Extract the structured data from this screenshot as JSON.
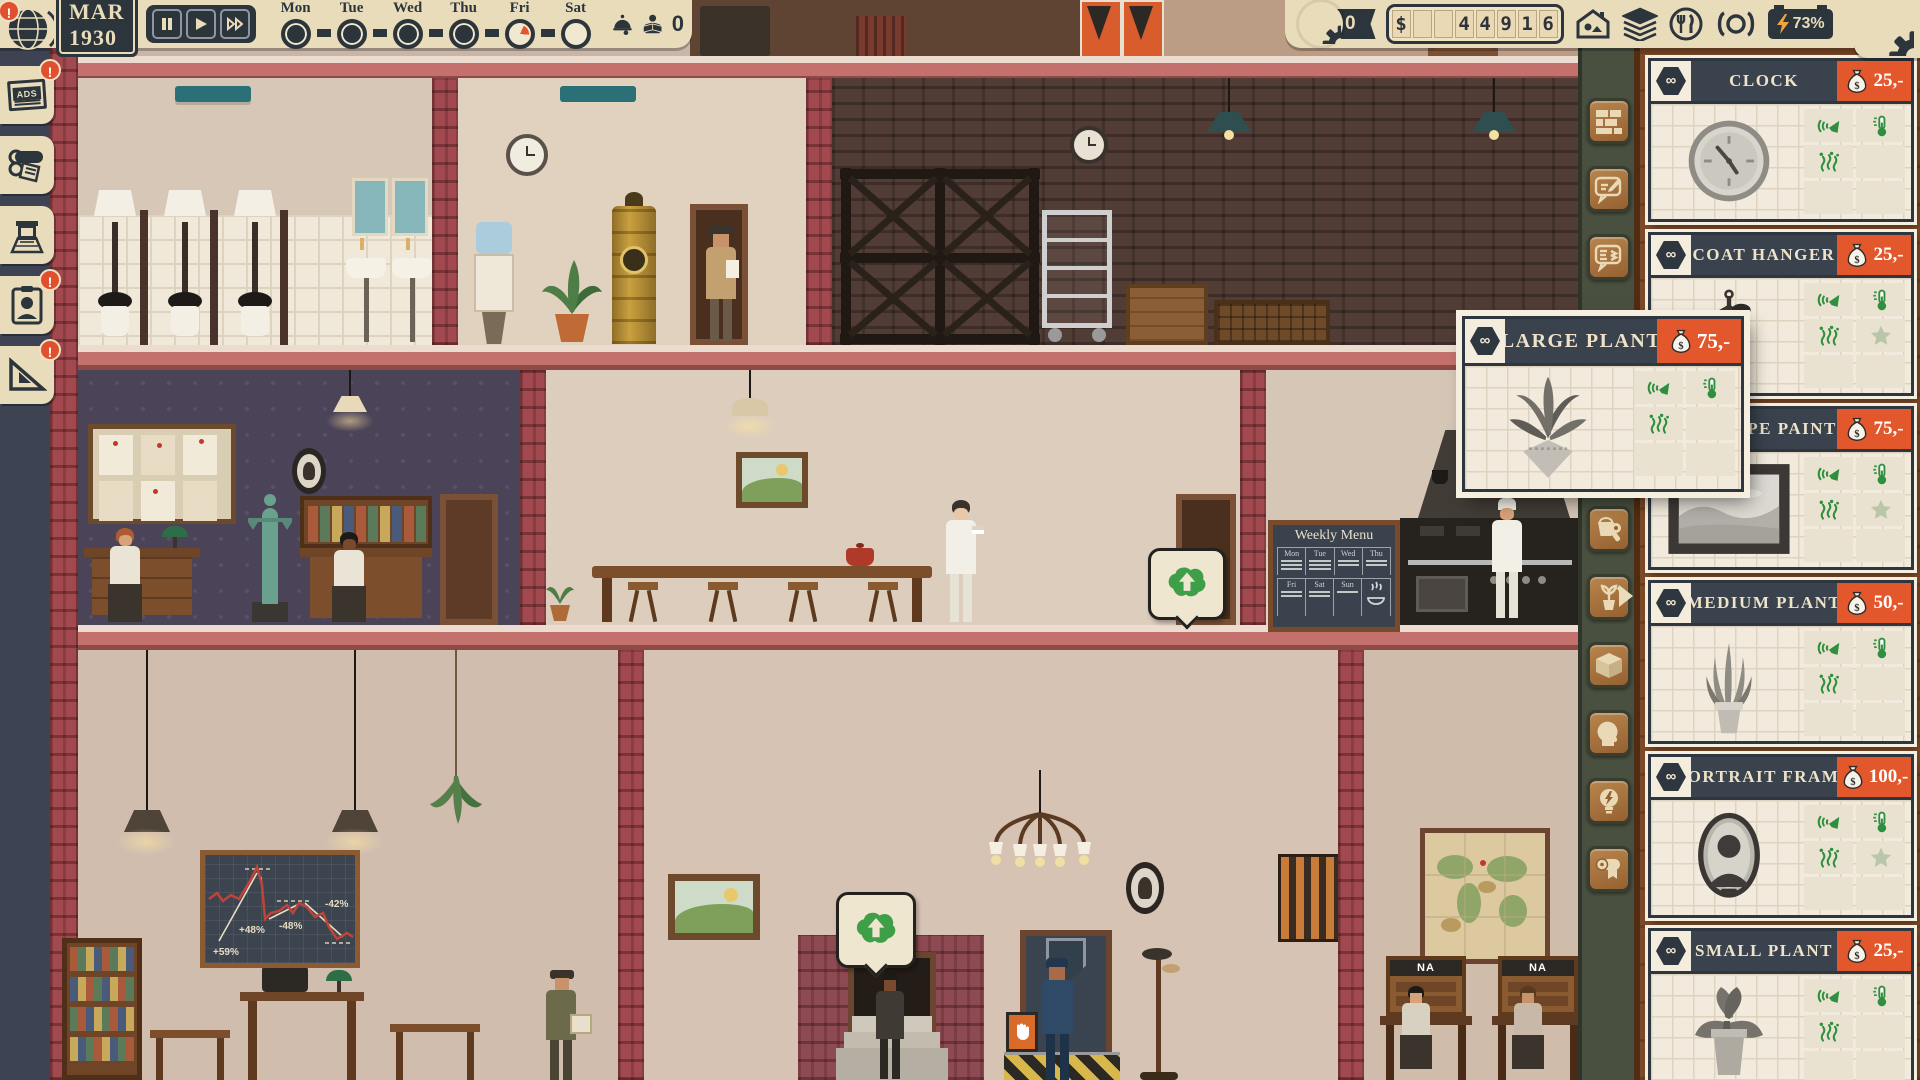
{
  "hud": {
    "alert_symbol": "!",
    "date": "MAR 1930",
    "days": [
      {
        "label": "Mon",
        "state": "done"
      },
      {
        "label": "Tue",
        "state": "done"
      },
      {
        "label": "Wed",
        "state": "done"
      },
      {
        "label": "Thu",
        "state": "done"
      },
      {
        "label": "Fri",
        "state": "partial"
      },
      {
        "label": "Sat",
        "state": "empty"
      }
    ],
    "readers_count": "0",
    "badge_count": "0",
    "money_cells": [
      "$",
      "",
      "",
      "4",
      "4",
      "9",
      "1",
      "6"
    ],
    "battery_percent": "73%"
  },
  "left_toolbar": {
    "items": [
      {
        "name": "ads",
        "label": "ADS",
        "alert": true
      },
      {
        "name": "printing-press",
        "alert": false
      },
      {
        "name": "newsstand",
        "alert": false
      },
      {
        "name": "staff",
        "alert": true
      },
      {
        "name": "construction",
        "alert": true
      }
    ]
  },
  "right_toolbar": {
    "items": [
      {
        "name": "build-walls"
      },
      {
        "name": "write-article"
      },
      {
        "name": "article-queue"
      },
      {
        "name": "maintenance"
      },
      {
        "name": "decorations",
        "selected": true
      },
      {
        "name": "storage"
      },
      {
        "name": "staff"
      },
      {
        "name": "electricity"
      },
      {
        "name": "paper-roll"
      }
    ]
  },
  "shop": {
    "stock_symbol": "∞",
    "currency_symbol": "$",
    "items": [
      {
        "name": "CLOCK",
        "price": "25,-",
        "has_star": false
      },
      {
        "name": "COAT HANGER",
        "price": "25,-",
        "has_star": true
      },
      {
        "name": "LANDSCAPE PAINTING",
        "price": "75,-",
        "has_star": true
      },
      {
        "name": "MEDIUM PLANT",
        "price": "50,-",
        "has_star": false
      },
      {
        "name": "PORTRAIT FRAME",
        "price": "100,-",
        "has_star": true
      },
      {
        "name": "SMALL PLANT",
        "price": "25,-",
        "has_star": false
      }
    ]
  },
  "popup": {
    "name": "LARGE PLANT",
    "price": "75,-",
    "has_star": false
  },
  "scene": {
    "weekly_menu": {
      "title": "Weekly Menu",
      "days": [
        "Mon",
        "Tue",
        "Wed",
        "Thu",
        "Fri",
        "Sat",
        "Sun"
      ]
    },
    "chart_board": {
      "annotations": [
        "+59%",
        "+48%",
        "-48%",
        "-42%"
      ]
    },
    "phone_desk_label": "NA"
  }
}
